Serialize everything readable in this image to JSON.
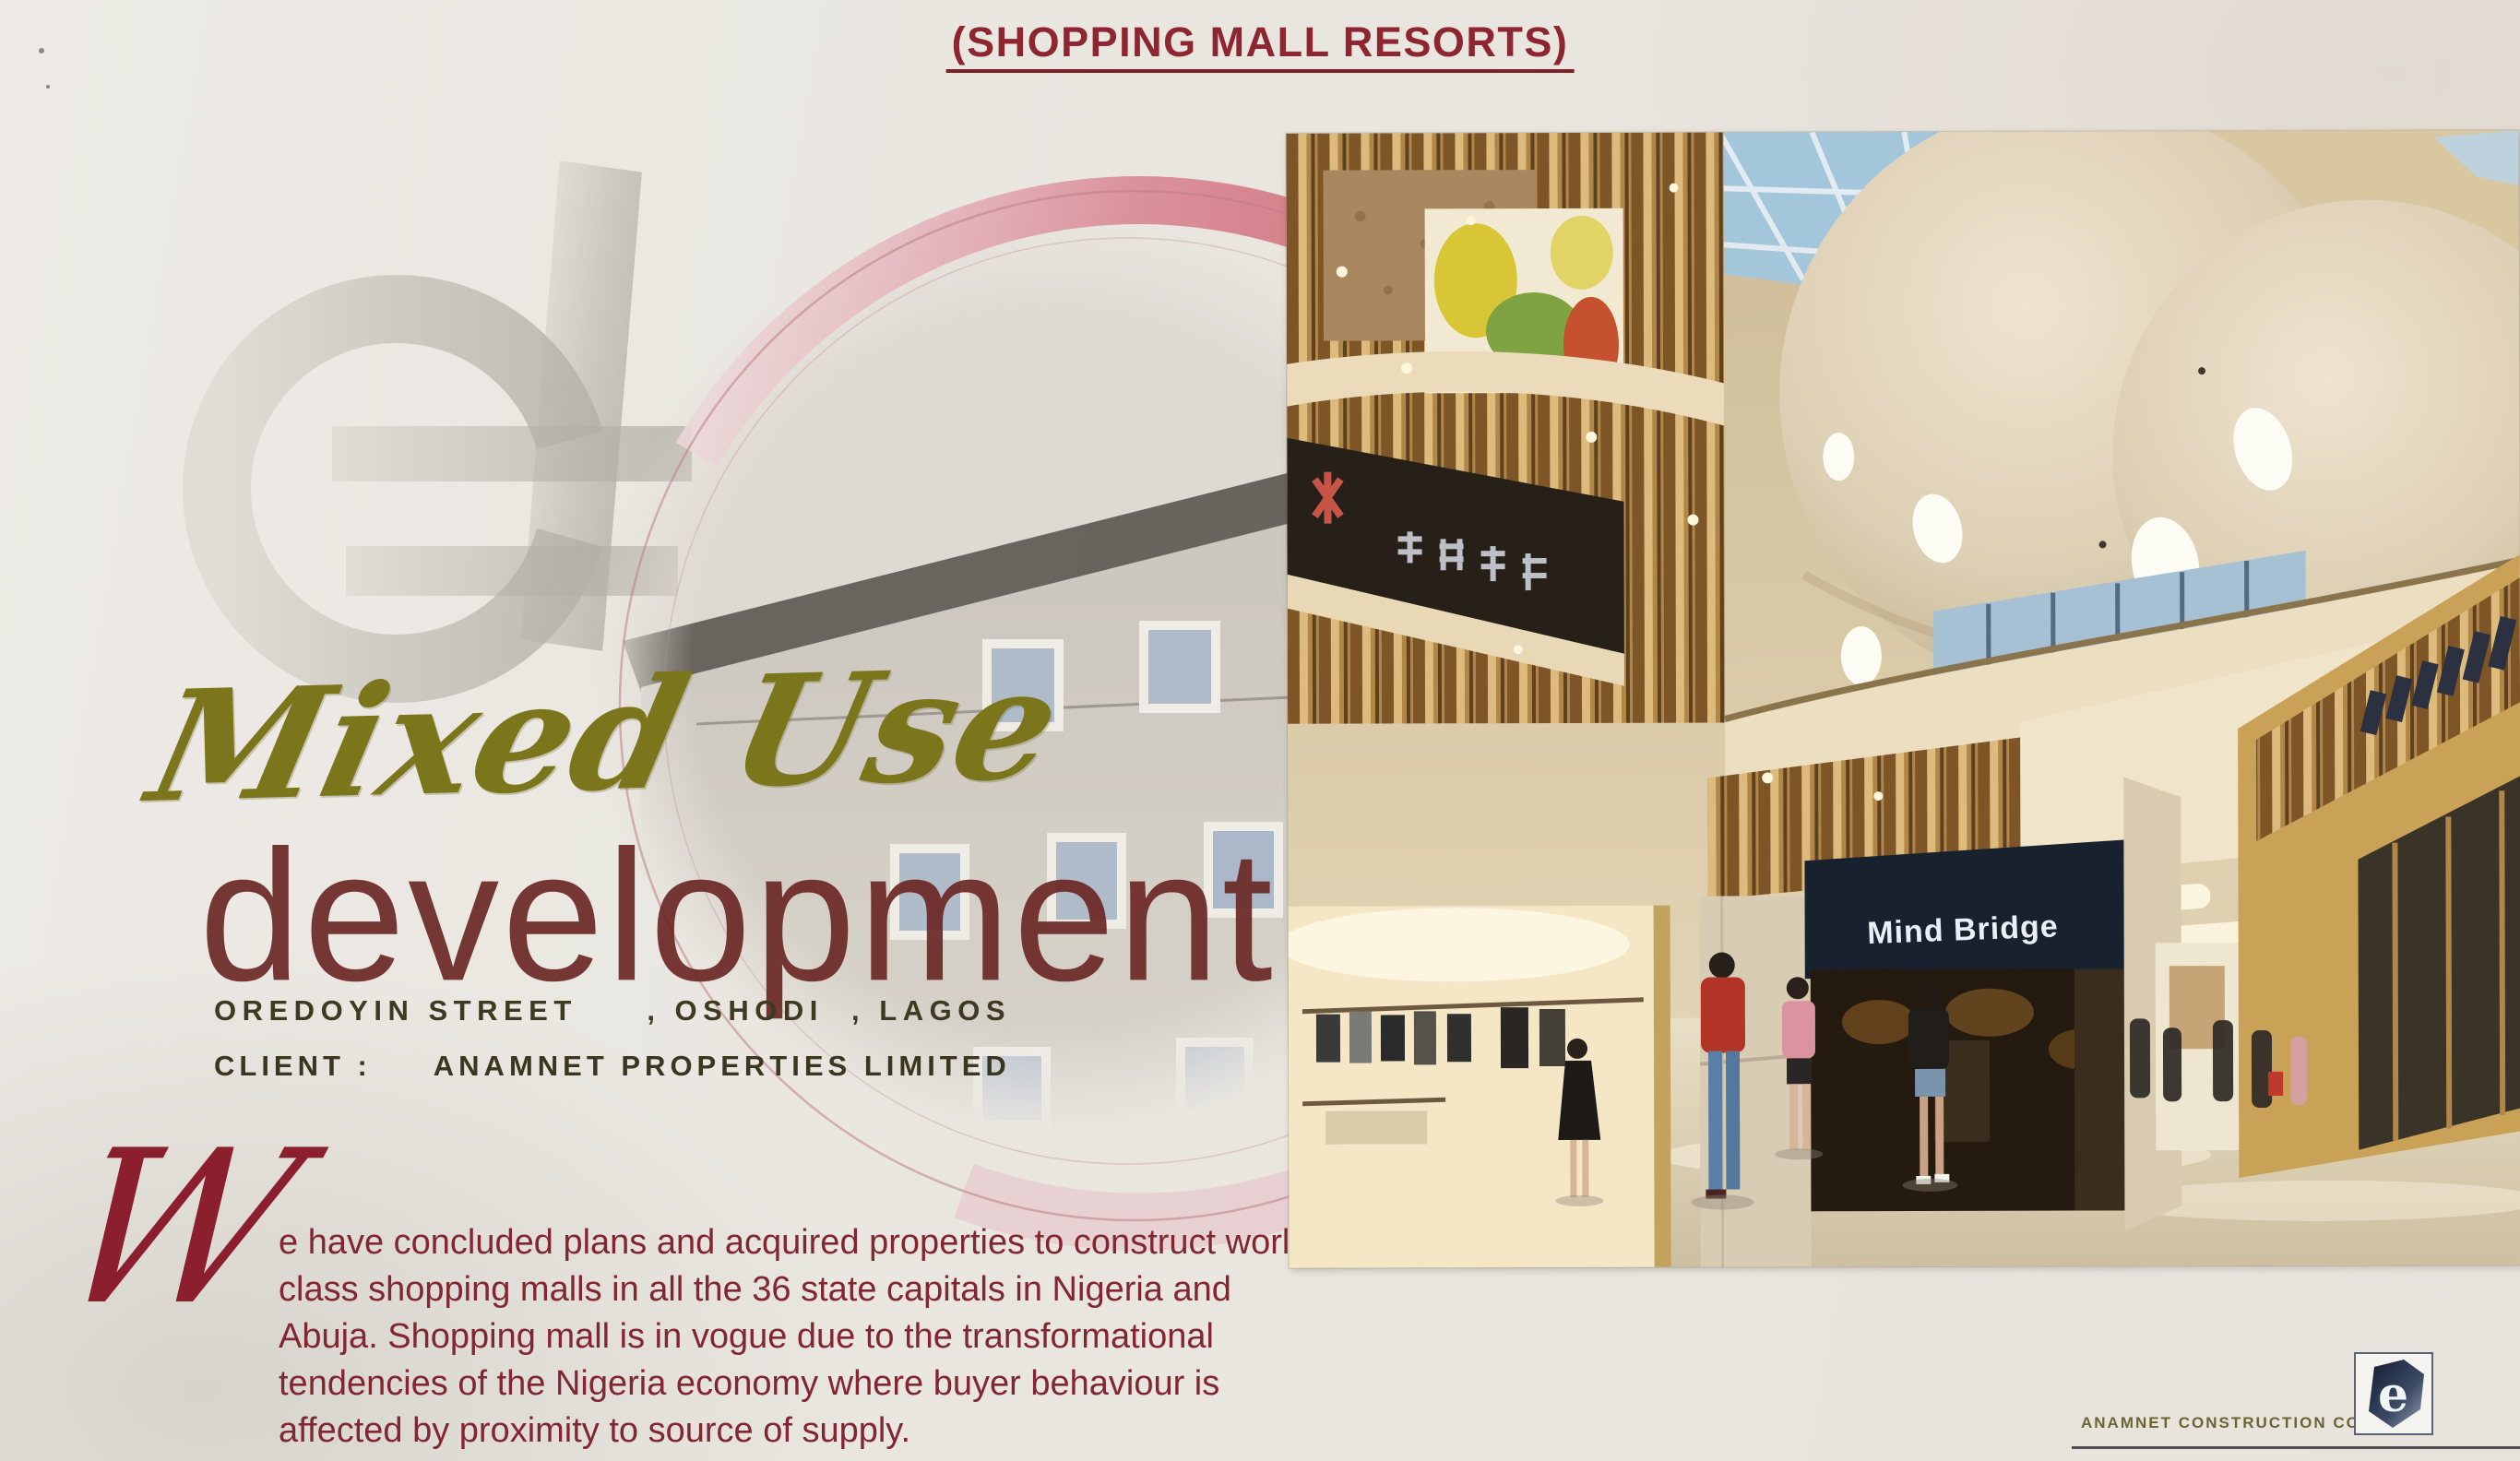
{
  "header": {
    "title": "(SHOPPING MALL RESORTS)"
  },
  "project": {
    "script_title": "Mixed Use",
    "main_title": "development",
    "address": "OREDOYIN STREET     , OSHODI  , LAGOS",
    "client_line": "CLIENT :     ANAMNET PROPERTIES LIMITED"
  },
  "body": {
    "dropcap": "W",
    "lines": [
      "e have concluded plans and acquired properties to construct world",
      "class shopping malls in all the 36 state capitals in Nigeria and",
      "Abuja. Shopping mall is in vogue due to the transformational",
      "tendencies of the Nigeria economy where buyer behaviour is",
      "affected by proximity to source of supply."
    ]
  },
  "photo": {
    "signs": {
      "mind_bridge": "Mind Bridge"
    }
  },
  "footer": {
    "company": "ANAMNET CONSTRUCTION COMPANY",
    "logo_letter": "e"
  },
  "colors": {
    "paper": "#e9e6e0",
    "title_maroon": "#8d2630",
    "script_olive": "#7b761b",
    "development_red": "#6a2725",
    "text_dark_olive": "#3e3a22",
    "paragraph_maroon": "#822631",
    "ring_pink": "#cf6d78",
    "sign_navy": "#18222f"
  }
}
